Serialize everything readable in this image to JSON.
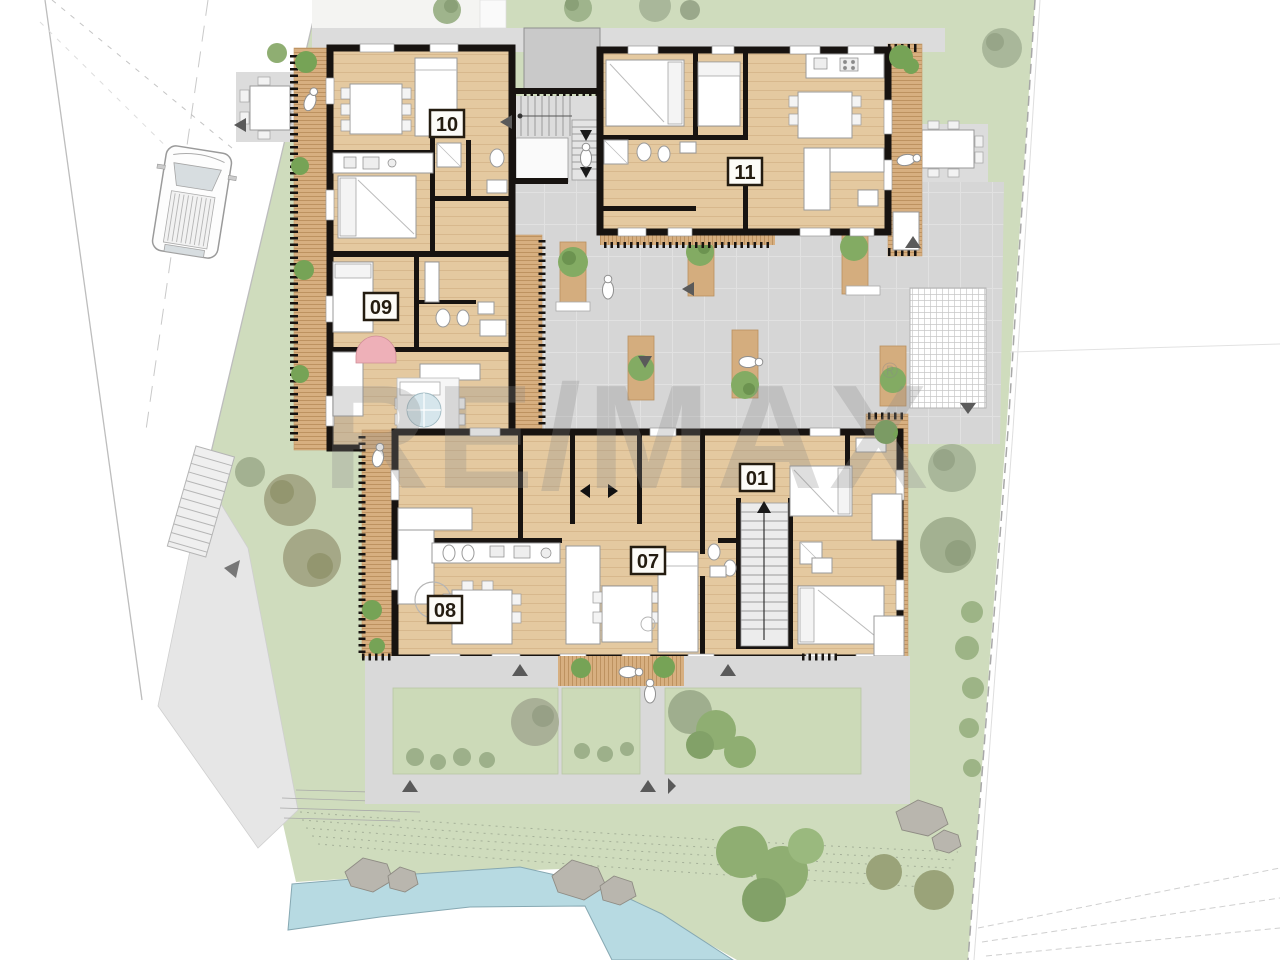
{
  "plan": {
    "type": "architectural-site-floor-plan",
    "units": [
      {
        "id": "unit-10",
        "label": "10"
      },
      {
        "id": "unit-11",
        "label": "11"
      },
      {
        "id": "unit-09",
        "label": "09"
      },
      {
        "id": "unit-01",
        "label": "01"
      },
      {
        "id": "unit-07",
        "label": "07"
      },
      {
        "id": "unit-08",
        "label": "08"
      }
    ],
    "watermark": {
      "text": "RE/MAX",
      "registered": "®"
    },
    "colors": {
      "lawn": "#cfdcbd",
      "garden_plot": "#cbd9b6",
      "wood_floor": "#e4c9a0",
      "deck": "#d7af80",
      "wall": "#171310",
      "paving": "#d6d6d6",
      "path_gray": "#d9d9d9",
      "water": "#b7dae2",
      "rock": "#b9b6ae",
      "tree_green": "#8fae72",
      "tree_gray_green": "#a3b191",
      "tree_olive": "#a5a887",
      "watermark": "#8a8a8a",
      "label_bg": "#fcfbf7",
      "label_border": "#241c10"
    }
  }
}
